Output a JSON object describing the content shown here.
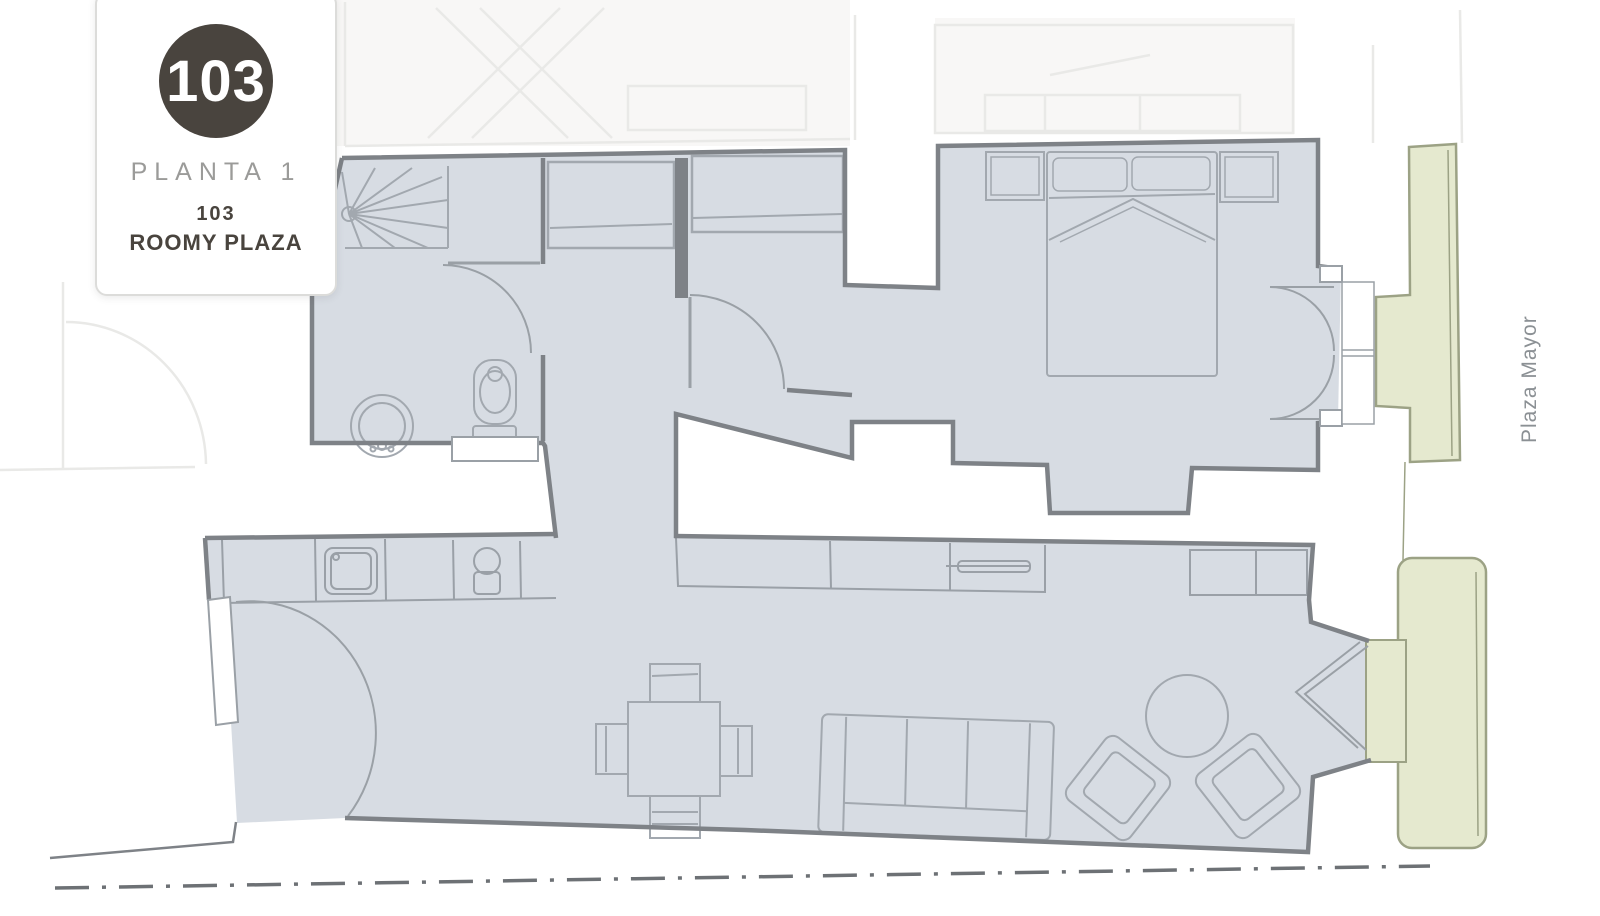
{
  "card": {
    "number": "103",
    "floor": "PLANTA 1",
    "unit_number": "103",
    "unit_name": "ROOMY PLAZA"
  },
  "labels": {
    "street": "Plaza Mayor"
  },
  "colors": {
    "apartment_fill": "#d7dce3",
    "balcony_fill": "#e5e9cf",
    "balcony_stroke": "#9ca285",
    "wall": "#7e8287",
    "furniture": "#a2a8af",
    "counter": "#9aa0a7",
    "door": "#9aa0a6",
    "faint": "#e9e9e7",
    "faint_fill": "#f8f7f6",
    "boundary": "#6d7175",
    "badge_bg": "#49443e",
    "badge_text": "#ffffff",
    "floor_text": "#9b9b99",
    "unit_text": "#49443e",
    "street_text": "#8b9094"
  }
}
